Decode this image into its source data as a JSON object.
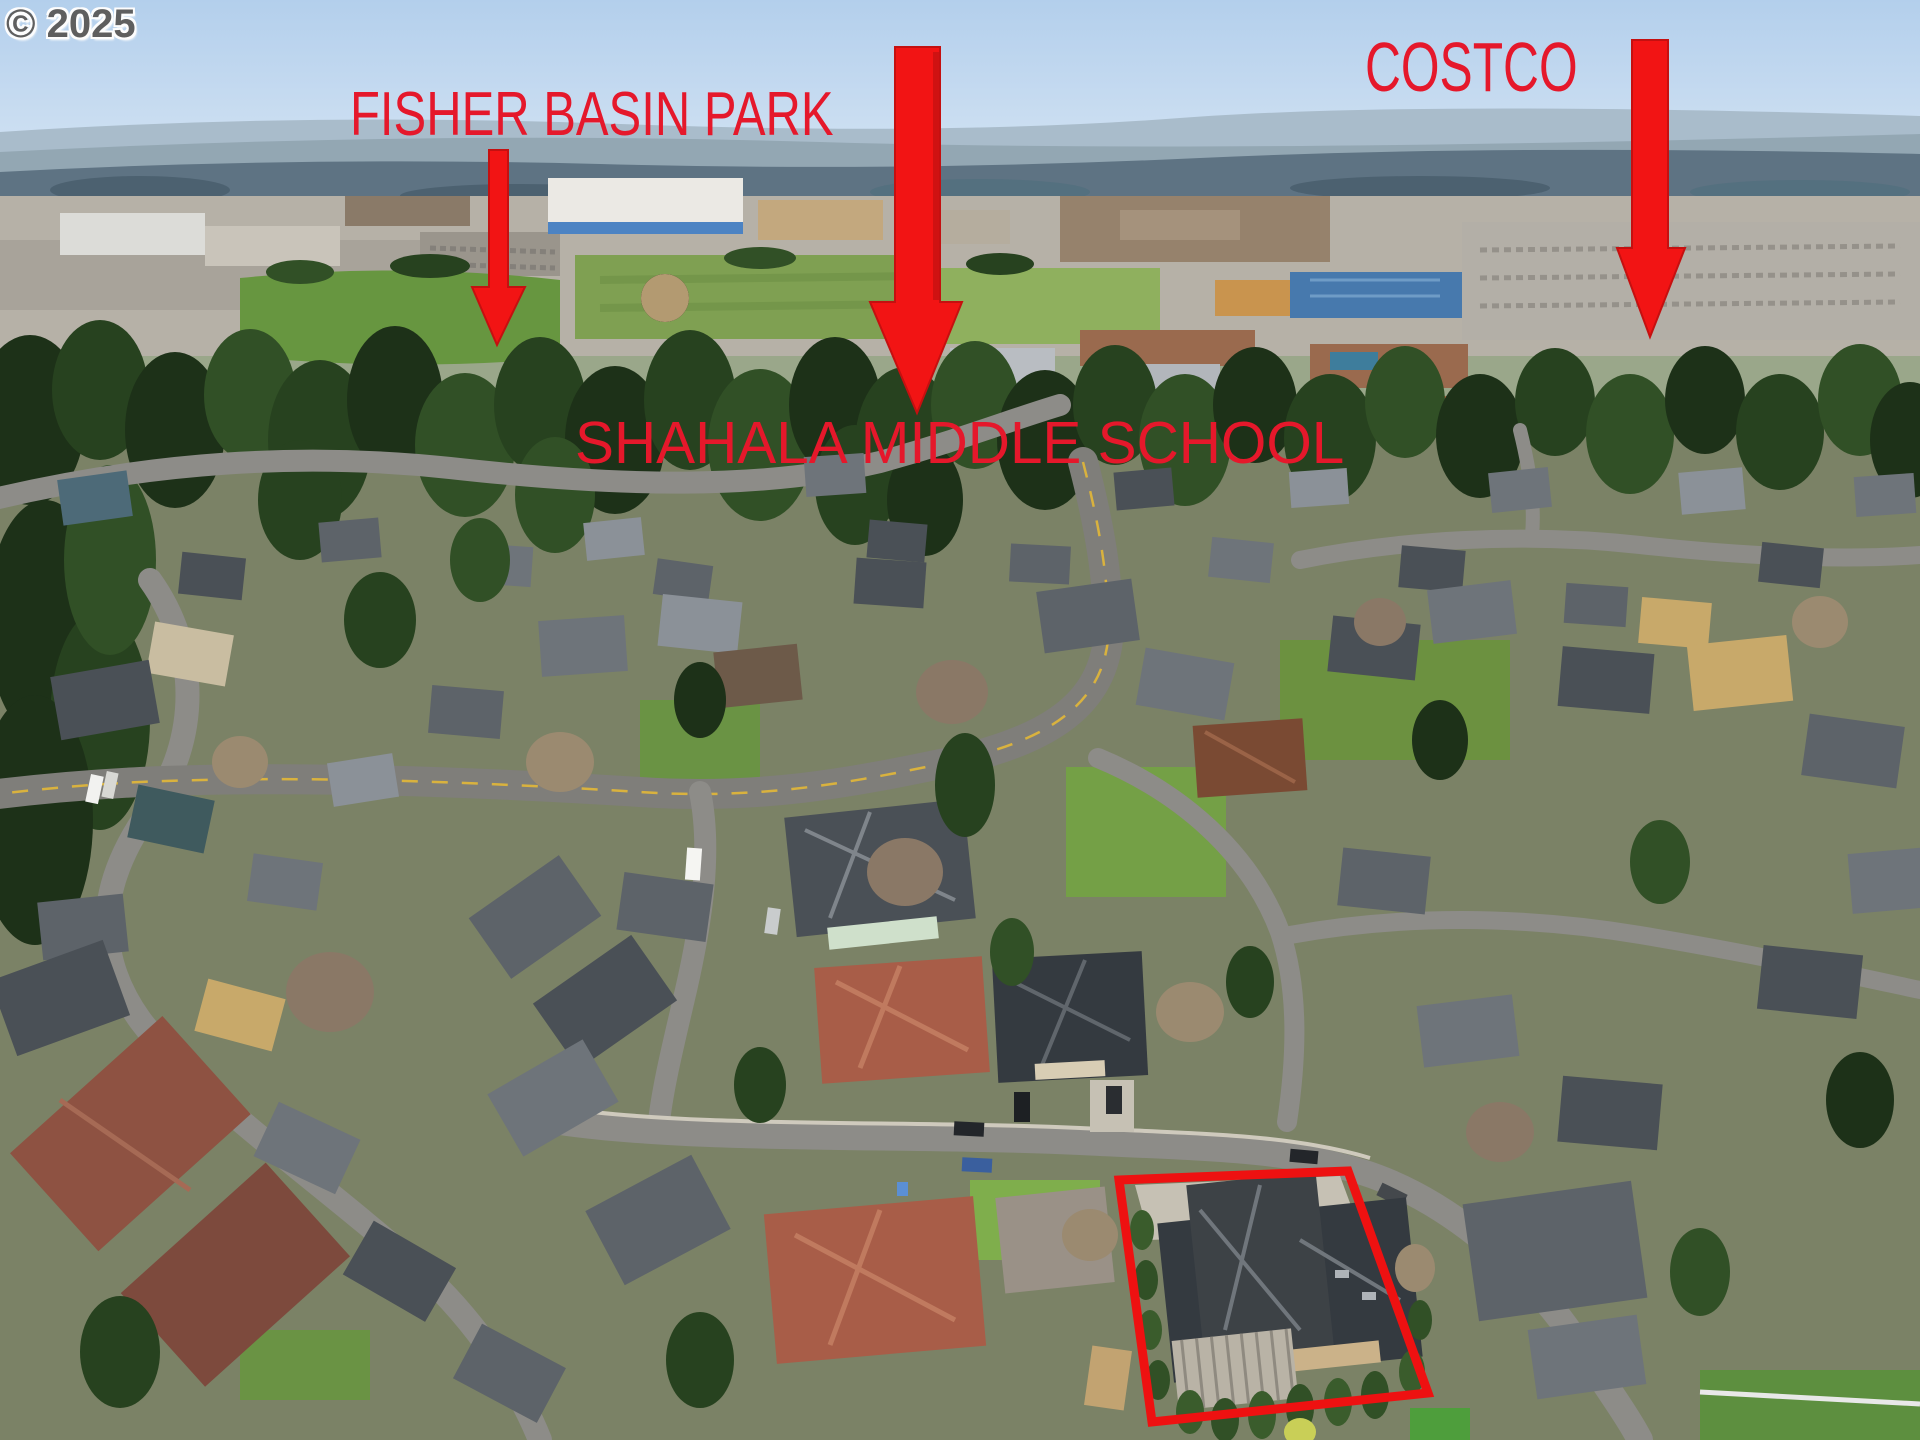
{
  "watermark": {
    "text": "© 2025"
  },
  "annotations": {
    "text_color": "#e5182b",
    "arrow_color": "#f21414",
    "outline_color": "#ee1111",
    "labels": [
      {
        "text": "FISHER BASIN PARK",
        "points_to": "green park space, upper left"
      },
      {
        "text": "SHAHALA MIDDLE SCHOOL",
        "points_to": "school campus behind evergreen tree line, center"
      },
      {
        "text": "COSTCO",
        "points_to": "blue-roofed warehouse, upper right"
      }
    ],
    "arrows": [
      {
        "name": "park-arrow",
        "tip_x": 497,
        "tip_y": 345
      },
      {
        "name": "school-arrow",
        "tip_x": 917,
        "tip_y": 413
      },
      {
        "name": "costco-arrow",
        "tip_x": 1650,
        "tip_y": 337
      }
    ],
    "property_outline": {
      "shape": "quadrilateral",
      "corners": [
        [
          1119,
          1180
        ],
        [
          1348,
          1171
        ],
        [
          1428,
          1393
        ],
        [
          1152,
          1422
        ]
      ]
    }
  },
  "scene": {
    "type": "aerial drone photo of suburban neighborhood",
    "sky_color": "#bdd5ee",
    "visible_features": [
      "hazy forested ridge on horizon",
      "commercial retail district in midground",
      "green park and school sports fields",
      "dense evergreen tree line",
      "curving residential streets with single-family homes",
      "subject home with dark roof outlined in red"
    ]
  }
}
